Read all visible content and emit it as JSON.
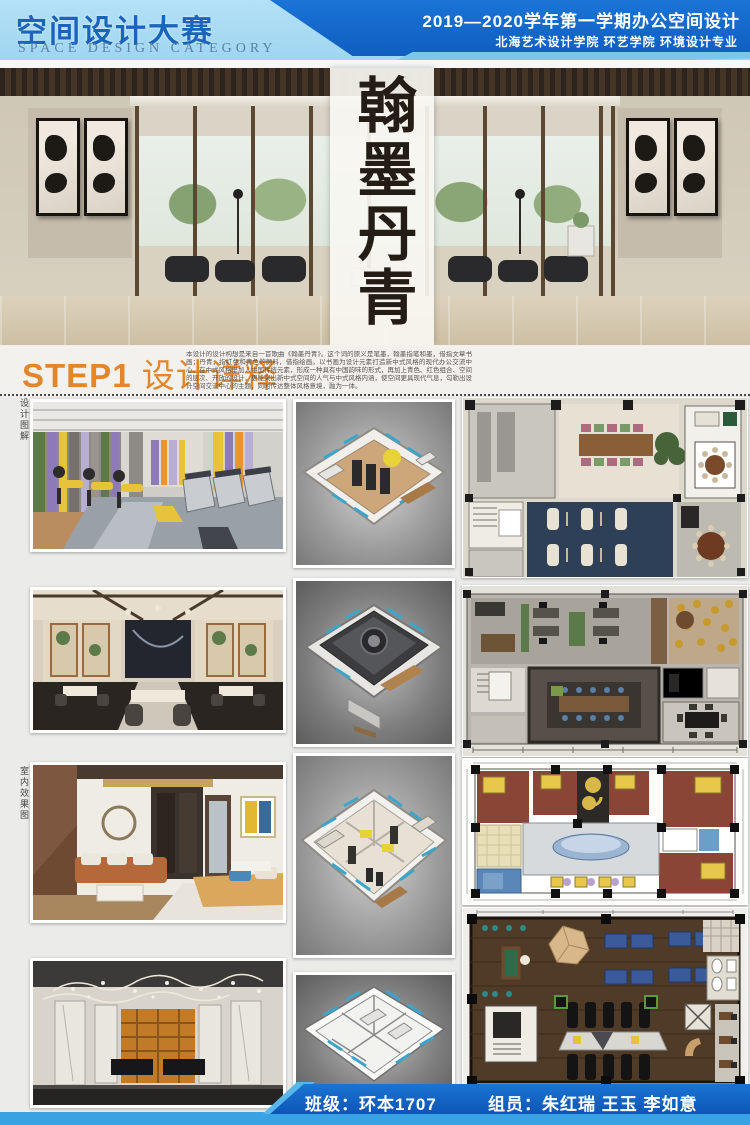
{
  "header": {
    "title": "空间设计大赛",
    "subtitle": "SPACE DESIGN CATEGORY",
    "term_line": "2019—2020学年第一学期办公空间设计",
    "dept_line": "北海艺术设计学院  环艺学院  环境设计专业"
  },
  "hero": {
    "calligraphy": "翰墨丹青"
  },
  "step1": {
    "step": "STEP1 ",
    "title": "设计详释",
    "paragraph": "本设计的设计构想是来自一首歌曲《翰墨丹青》。这个词的原义是笔墨，翰墨指笔和墨，借指文章书画；丹青，指红色和青色的颜料，借指绘画。以书画为设计元素打造新中式风格的现代办公交流中心，在中式风格里加入中国传统元素，形成一种具有中国韵味的形式，再加上青色、红色组合、空间的层次、开放的设计，更能突出新中式空间的人气与中式风格内涵，使空间更具现代气息，勾勒出设计空间交流中心的主题，同时传达整体风格意境，融为一体。"
  },
  "side_labels": {
    "top": "设计图解",
    "bottom": "室内效果图"
  },
  "footer": {
    "class_field": "班级：环本1707",
    "team_field": "组员：朱红瑞  王玉  李如意"
  },
  "colors": {
    "header_light_blue": "#a9dcf4",
    "header_dark_blue": "#1365c6",
    "accent_orange": "#e2862c",
    "footer_blue": "#1160c4",
    "footer_light_blue": "#38a2e2"
  }
}
